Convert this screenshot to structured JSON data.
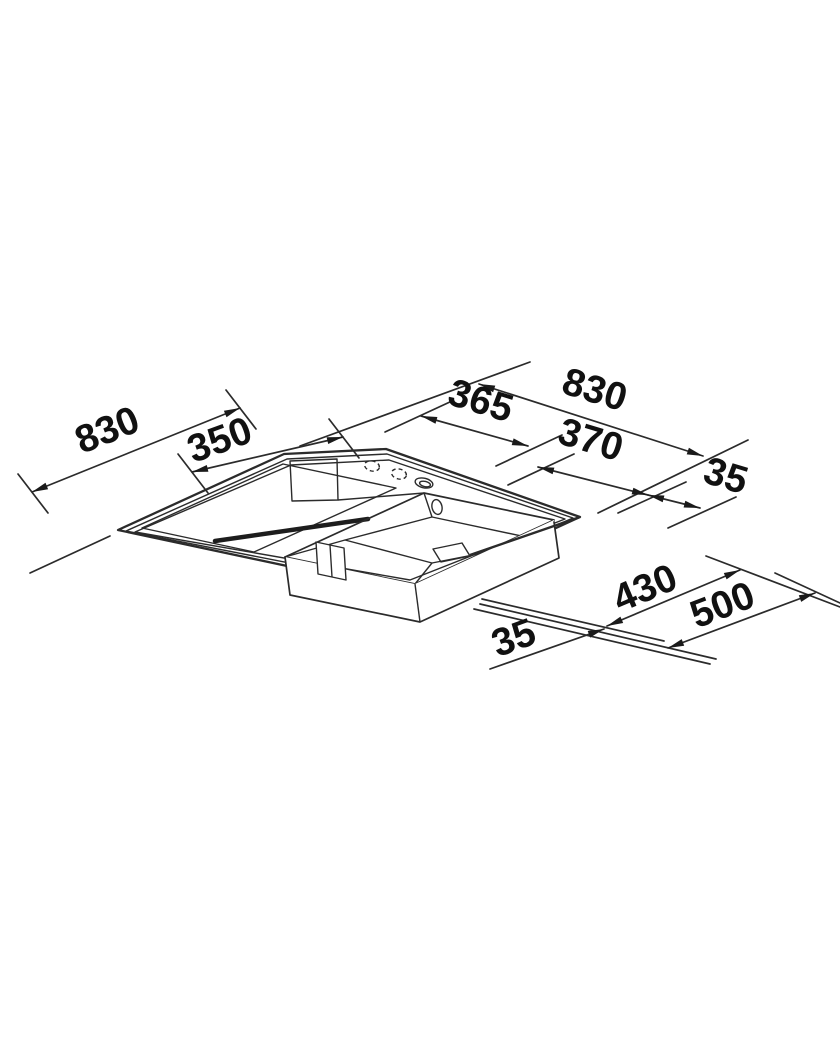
{
  "diagram": {
    "kind": "sink-dimension-drawing",
    "dimensions": {
      "top": {
        "overall": "830",
        "segment_left": "365",
        "segment_mid": "370",
        "margin_right": "35"
      },
      "left": {
        "overall": "830",
        "segment": "350"
      },
      "bottom": {
        "margin_front": "35",
        "bowl_depth": "430",
        "overall_depth": "500"
      }
    },
    "colors": {
      "line": "#2b2b2b",
      "label": "#111111",
      "background": "#ffffff"
    }
  }
}
